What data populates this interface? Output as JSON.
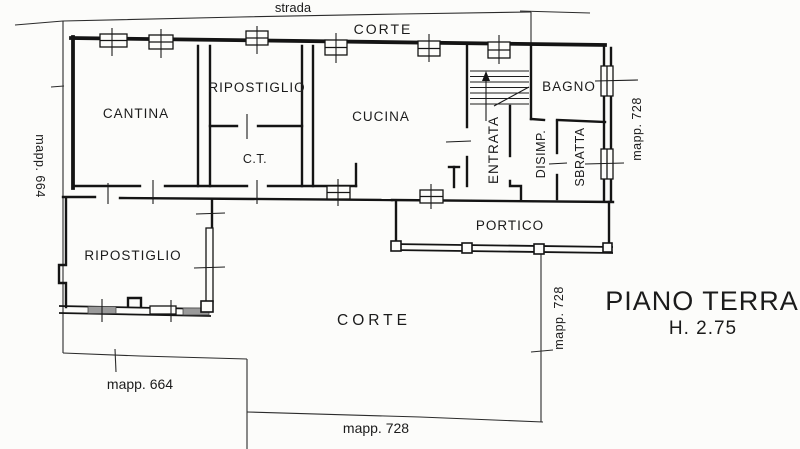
{
  "plan": {
    "title": "PIANO TERRA",
    "height_note": "H. 2.75"
  },
  "rooms": {
    "cantina": "CANTINA",
    "ripostiglio_top": "RIPOSTIGLIO",
    "ct": "C.T.",
    "cucina": "CUCINA",
    "entrata": "ENTRATA",
    "bagno": "BAGNO",
    "disimp": "DISIMP.",
    "sbratta": "SBRATTA",
    "portico": "PORTICO",
    "ripostiglio_bottom": "RIPOSTIGLIO"
  },
  "outdoor": {
    "strada": "strada",
    "corte_top": "CORTE",
    "corte_bottom": "CORTE",
    "mapp_664_left": "mapp. 664",
    "mapp_664_bottom": "mapp. 664",
    "mapp_728_right": "mapp. 728",
    "mapp_728_center": "mapp. 728",
    "mapp_728_bottom": "mapp. 728"
  },
  "colors": {
    "ink": "#1b1b1b",
    "paper": "#fcfcfa",
    "window_shade": "#9a9a9a"
  }
}
